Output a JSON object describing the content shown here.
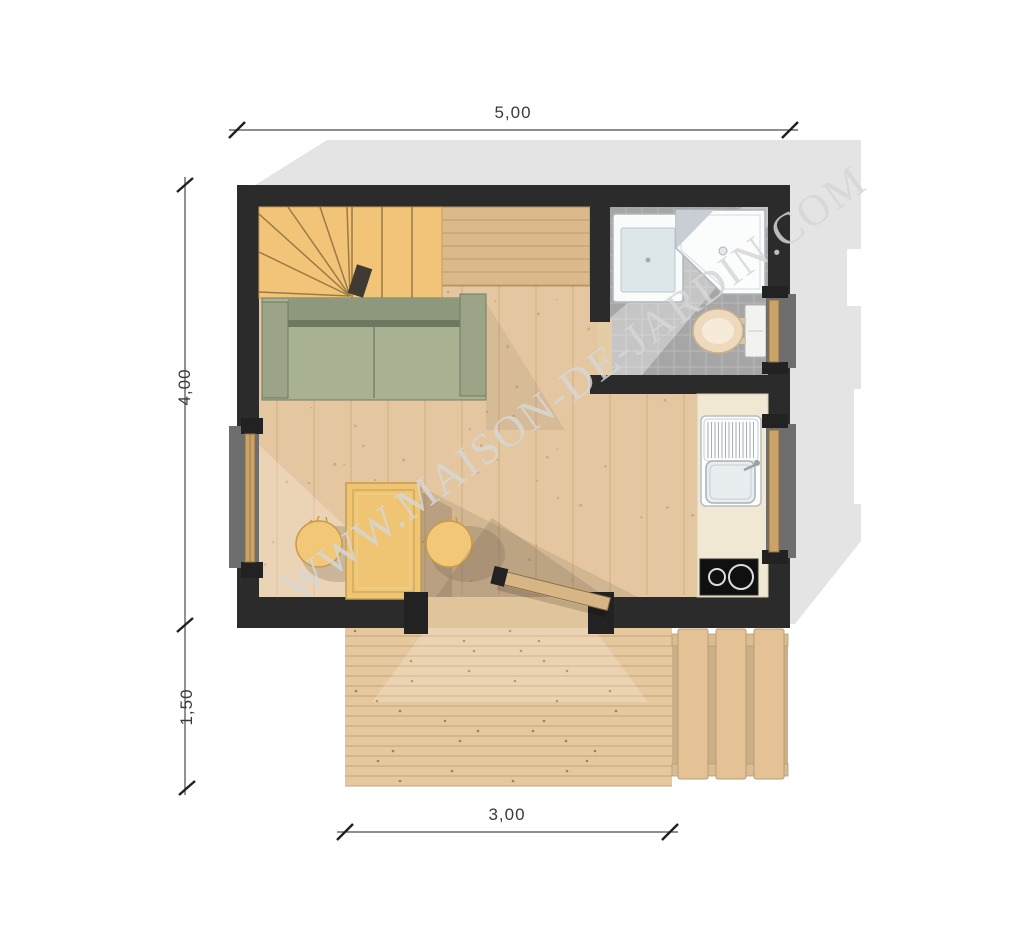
{
  "watermark": {
    "text": "WWW.MAISON-DE-JARDIN.COM"
  },
  "dimensions": {
    "total_width": "5,00",
    "total_depth": "4,00",
    "terrace_depth": "1,50",
    "terrace_width": "3,00"
  },
  "colors": {
    "roof_shadow": "#E4E4E5",
    "wall": "#2B2B2B",
    "floor_wood": "#E4C7A0",
    "floor_plank_line": "#D0AC7E",
    "floor_speckle": "#B98F63",
    "stairs_wood": "#F1C477",
    "stair_edge": "#9A7A46",
    "loft_wood": "#DCB98B",
    "loft_line": "#C09A66",
    "sofa_seat": "#A9B193",
    "sofa_dark": "#8E987C",
    "table_wood": "#EFC573",
    "bathroom_tile": "#A6A6A6",
    "tile_grout": "#BABABA",
    "fixture_white": "#FBFDFD",
    "toilet_seat": "#EFD9BD",
    "kitchen_counter": "#F1E8D3",
    "cooktop_black": "#101010",
    "deck_wood": "#E6C89E",
    "deck_gap": "#C4A379",
    "deck_nail": "#8F6F4C",
    "step_wood": "#E4C295",
    "window_frame_wood": "#C9A368",
    "dimension_line": "#4A4A4A",
    "watermark_gray": "#D6D6D6"
  },
  "render": {
    "floor_plank_step": 37,
    "floor_speckle_count": 85,
    "loft_line_step": 13,
    "deck_plank_count": 16,
    "terrace_step_count": 3,
    "tile_size": 16,
    "stair_fan_targets": [
      [
        259,
        292
      ],
      [
        259,
        252
      ],
      [
        259,
        214
      ],
      [
        288,
        207
      ],
      [
        320,
        207
      ],
      [
        347,
        207
      ]
    ],
    "stair_tread_xs": [
      352,
      382,
      412
    ]
  }
}
